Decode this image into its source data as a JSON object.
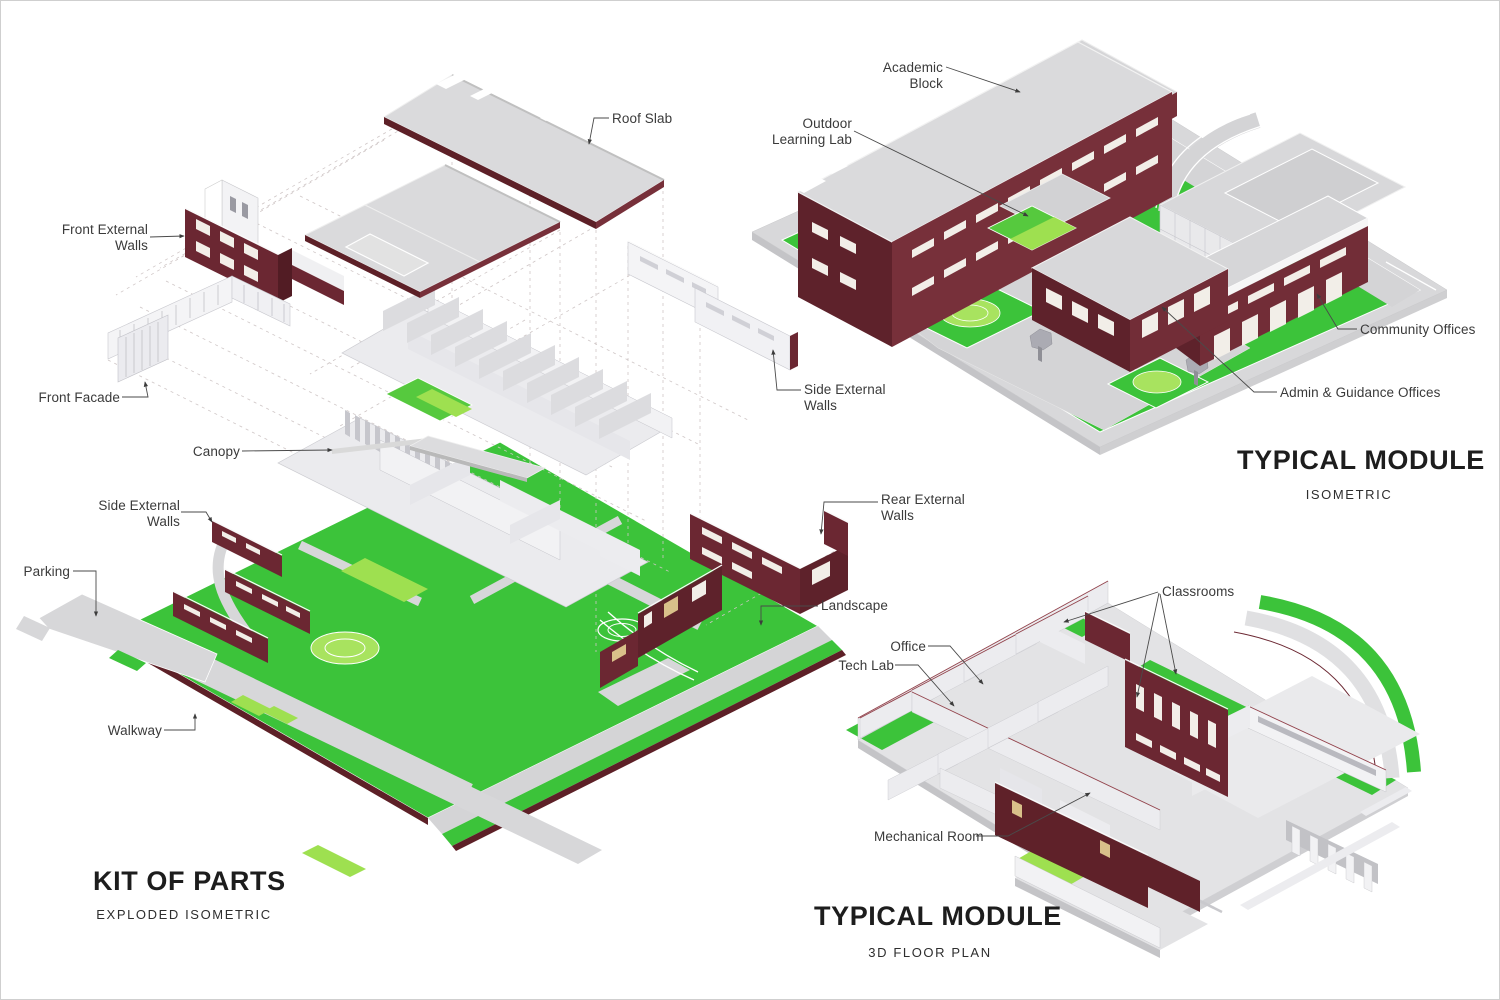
{
  "palette": {
    "maroon": "#6b2732",
    "maroon_dark": "#5e222b",
    "maroon_light": "#77303a",
    "maroon_edge": "#5d2027",
    "maroon_cap": "#521c24",
    "mech_maroon": "#5f2129",
    "roof_gray": "#dadadc",
    "slab_side": "#c4c4c7",
    "grass_green": "#3cc33a",
    "grass_bright": "#56c93e",
    "grass_light": "#9ee050",
    "mound_green": "#a8e35f",
    "path_gray": "#d4d4d6",
    "walk_gray": "#d7d7d9",
    "wall_white": "#f2f2f4",
    "wall_light": "#ececef",
    "wall_mid": "#e6e6ea",
    "wall_dim": "#dcdcdf",
    "fin_gray": "#c6c6cc",
    "window_white": "#f2eee8",
    "window_tan": "#d9c08a",
    "glass_gray": "#c2c2c6",
    "tree_gray": "#ababb3",
    "floor_gray": "#e3e3e5",
    "dash_gray": "#cfc6c6",
    "leader_gray": "#4a4a4a",
    "text_gray": "#3a3a3a",
    "title_color": "#1d1d1d"
  },
  "views": {
    "kit": {
      "title": "KIT OF PARTS",
      "subtitle": "EXPLODED ISOMETRIC",
      "labels": {
        "roof_slab": "Roof Slab",
        "front_external_walls": "Front External Walls",
        "front_facade": "Front Facade",
        "canopy": "Canopy",
        "side_external_walls_left": "Side External Walls",
        "parking": "Parking",
        "walkway": "Walkway",
        "side_external_walls_right": "Side External Walls",
        "rear_external_walls": "Rear External Walls",
        "landscape": "Landscape"
      }
    },
    "iso": {
      "title": "TYPICAL MODULE",
      "subtitle": "ISOMETRIC",
      "labels": {
        "academic_block": "Academic Block",
        "outdoor_learning_lab": "Outdoor Learning Lab",
        "community_offices": "Community Offices",
        "admin_guidance_offices": "Admin & Guidance Offices"
      }
    },
    "plan": {
      "title": "TYPICAL MODULE",
      "subtitle": "3D FLOOR PLAN",
      "labels": {
        "classrooms": "Classrooms",
        "office": "Office",
        "tech_lab": "Tech Lab",
        "mechanical_room": "Mechanical Room"
      }
    }
  }
}
